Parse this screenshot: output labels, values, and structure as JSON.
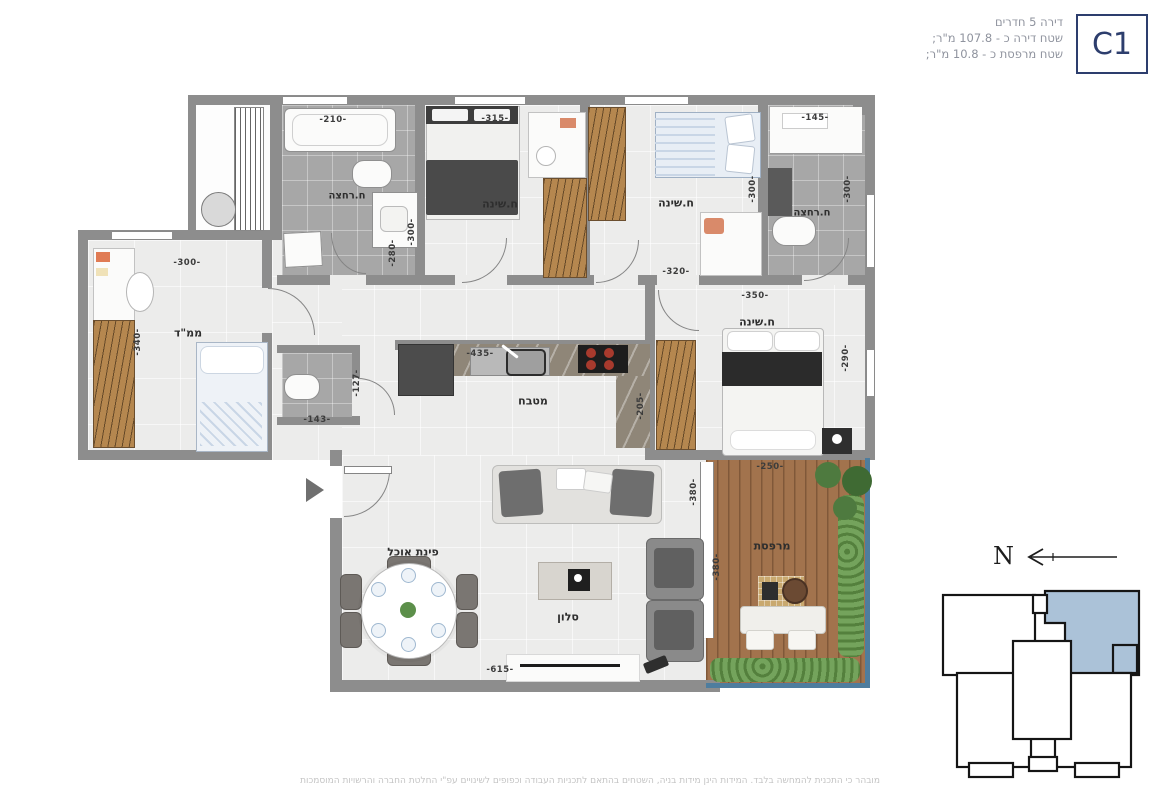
{
  "header": {
    "title": "דירה 5 חדרים",
    "apartment_area": "שטח דירה כ - 107.8 מ\"ר;",
    "balcony_area": "שטח מרפסת כ - 10.8 מ\"ר;",
    "unit_label": "C1"
  },
  "rooms": {
    "bath1": {
      "label": "ח.רחצה",
      "dim_w": "-210-",
      "dim_h": "-280-"
    },
    "bed1": {
      "label": "ח.שינה",
      "dim_w": "-315-",
      "dim_h": "-300-"
    },
    "bed2": {
      "label": "ח.שינה",
      "dim_w": "-320-",
      "dim_h": "-300-"
    },
    "bath2": {
      "label": "ח.רחצה",
      "dim_w": "-145-",
      "dim_h": "-300-"
    },
    "mamad": {
      "label": "ממ\"ד",
      "dim_w": "-300-",
      "dim_h": "-340-"
    },
    "wc": {
      "dim_w": "-143-",
      "dim_h": "-127-"
    },
    "kitchen": {
      "label": "מטבח",
      "dim_w": "-435-",
      "dim_h": "-205-"
    },
    "master": {
      "label": "ח.שינה",
      "dim_w": "-350-",
      "dim_h": "-290-"
    },
    "living": {
      "label": "סלון",
      "dim_w": "-615-",
      "dim_h": "-380-"
    },
    "dining": {
      "label": "פינת אוכל"
    },
    "balcony": {
      "label": "מרפסת",
      "dim_w": "-250-",
      "dim_h": "-380-"
    }
  },
  "compass": {
    "north_label": "N"
  },
  "footer": {
    "disclaimer": "מובהר כי התכנית להמחשה בלבד. המידות הינן מידות בניה, השטחים בהתאם לתכניות העבודה וכפופים לשינויים עפ\"י החלטת החברה והרשויות המוסמכות"
  },
  "colors": {
    "accent_navy": "#2d3e6d",
    "keyplan_highlight": "#abc2d8",
    "wall_gray": "#8d8d8d",
    "deck_wood": "#a2734d",
    "balcony_rail": "#4e7d9e"
  }
}
